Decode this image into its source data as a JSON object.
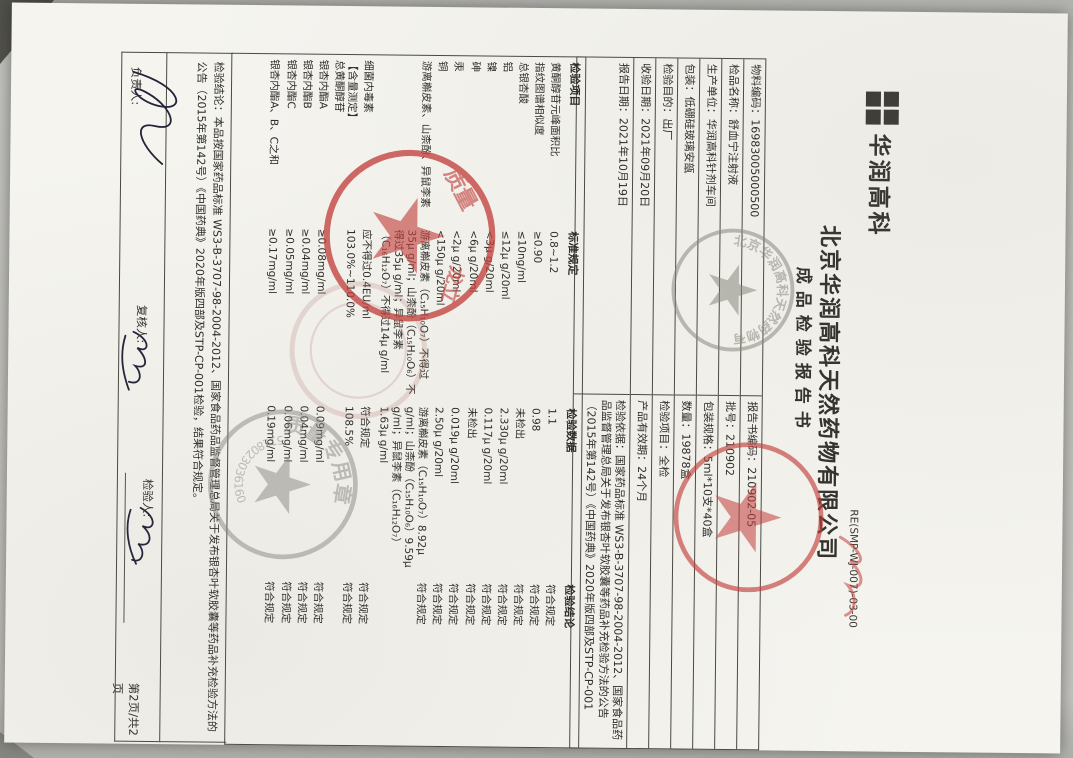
{
  "header": {
    "logo_text": "华润高科",
    "company": "北京华润高科天然药物有限公司",
    "doc_code": "RE(SMP-WJ-007)-03-00",
    "title": "成品检验报告书"
  },
  "info": {
    "left": [
      "物料编码：16983005000500",
      "检品名称：舒血宁注射液",
      "生产单位：华润高科针剂车间",
      "包装：低硼硅玻璃安瓿",
      "检验目的：出厂",
      "收验日期：2021年09月20日",
      "报告日期：2021年10月19日"
    ],
    "right": [
      "报告书编码：210902-05",
      "批号：210902",
      "包装规格：5ml*10支*40盒",
      "数量：19878盒",
      "检验项目：全检",
      "产品有效期：24个月",
      "检验依据：国家药品标准 WS3-B-3707-98-2004-2012、国家食品药品监督管理总局关于发布银杏叶软胶囊等药品补充检验方法的公告（2015年第142号）《中国药典》2020年版四部及STP-CP-001"
    ]
  },
  "items": {
    "headers": [
      "检验项目",
      "标准规定",
      "检验数据",
      "检验结论"
    ],
    "rows": [
      {
        "name": "黄酮醇苷元峰面积比",
        "standard": "0.8~1.2",
        "data": "1.1",
        "result": "符合规定"
      },
      {
        "name": "指纹图谱相似度",
        "standard": "≥0.90",
        "data": "0.98",
        "result": "符合规定"
      },
      {
        "name": "总银杏酸",
        "standard": "≤10ng/ml",
        "data": "未检出",
        "result": "符合规定"
      },
      {
        "name": "铝",
        "standard": "≤12μ g/20ml",
        "data": "2.330μ g/20ml",
        "result": "符合规定"
      },
      {
        "name": "镍",
        "standard": "<3μ g/20ml",
        "data": "0.117μ g/20ml",
        "result": "符合规定"
      },
      {
        "name": "砷",
        "standard": "<6μ g/20ml",
        "data": "未检出",
        "result": "符合规定"
      },
      {
        "name": "汞",
        "standard": "<2μ g/20ml",
        "data": "0.019μ g/20ml",
        "result": "符合规定"
      },
      {
        "name": "铜",
        "standard": "<150μ g/20ml",
        "data": "2.50μ g/20ml",
        "result": "符合规定"
      },
      {
        "name": "游离槲皮素、山柰酚、异鼠李素",
        "standard": "游离槲皮素（C₁₅H₁₀O₇）不得过35μ g/ml；山柰酚（C₁₅H₁₀O₆）不得过35μ g/ml；异鼠李素（C₁₆H₁₂O₇）不得过14μ g/ml",
        "data": "游离槲皮素（C₁₅H₁₀O₇）8.92μ g/ml；山柰酚（C₁₅H₁₀O₆）9.59μ g/ml；异鼠李素（C₁₆H₁₂O₇）1.63μ g/ml",
        "result": "符合规定"
      },
      {
        "name": "细菌内毒素",
        "standard": "应不得过0.4EU/ml",
        "data": "符合规定",
        "result": "符合规定"
      },
      {
        "name": "【含量测定】\n总黄酮醇苷",
        "standard": "103.0%~110.0%",
        "data": "108.5%",
        "result": "符合规定"
      },
      {
        "name": "银杏内酯A",
        "standard": "≥0.08mg/ml",
        "data": "0.09mg/ml",
        "result": "符合规定"
      },
      {
        "name": "银杏内酯B",
        "standard": "≥0.04mg/ml",
        "data": "0.04mg/ml",
        "result": "符合规定"
      },
      {
        "name": "银杏内酯C",
        "standard": "≥0.05mg/ml",
        "data": "0.06mg/ml",
        "result": "符合规定"
      },
      {
        "name": "银杏内酯A、B、C之和",
        "standard": "≥0.17mg/ml",
        "data": "0.19mg/ml",
        "result": "符合规定"
      }
    ]
  },
  "conclusion": "检验结论：本品按国家药品标准 WS3-B-3707-98-2004-2012、国家食品药品监督管理总局关于发布银杏叶软胶囊等药品补充检验方法的公告（2015年第142号）《中国药典》2020年版四部及STP-CP-001检验，结果符合规定。",
  "footer": {
    "responsible": "负责人:",
    "reviewer": "复核人:",
    "inspector": "检验人:",
    "page_no": "第2页/共2页"
  },
  "stamps": {
    "company_grey_arc": "北京华润高科天然药物有限公司",
    "red_big_frag1": "质量",
    "red_big_frag2": "龙立",
    "grey_qc_arc": "质量专用章",
    "grey_qc_serial": "5118023036160"
  },
  "colors": {
    "stamp_red": "#c5403c",
    "stamp_grey": "#8a8a82",
    "paper": "#f5f4ef",
    "ink": "#2c2b27"
  }
}
